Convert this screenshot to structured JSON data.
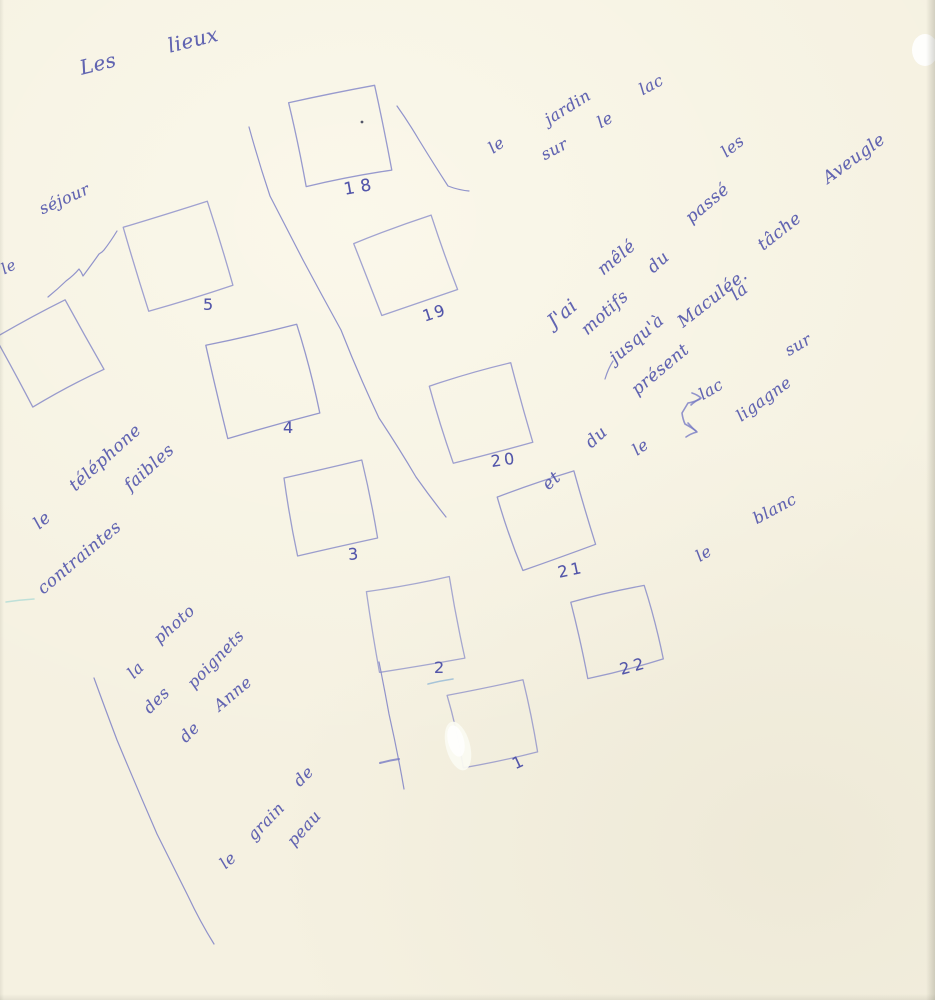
{
  "document": {
    "kind": "scanned handwritten notebook page",
    "language": "French",
    "paper_color": "#f5f1e1",
    "ink_color": "#5558ad",
    "transcription": {
      "title": "Les lieux",
      "notes": [
        "le séjour",
        "le téléphone — contraintes faibles",
        "la photo des poignets de Anne",
        "le grain de peau",
        "le jardin sur le lac",
        "J'ai mêlé les motifs du passé et du présent jusqu'à la tâche Aveugle Maculée.",
        "le lac — ligagne — sur",
        "le blanc"
      ],
      "numbered_squares": [
        "1",
        "2",
        "3",
        "4",
        "5",
        "18",
        "19",
        "20",
        "21",
        "22"
      ],
      "unnumbered_squares": 1
    }
  },
  "sketch": {
    "ink": "#777bc4",
    "words": [
      {
        "name": "title-word-les",
        "t": "Les",
        "x": 80,
        "y": 66,
        "r": -14,
        "s": 20
      },
      {
        "name": "title-word-lieux",
        "t": "lieux",
        "x": 168,
        "y": 44,
        "r": -14,
        "s": 20
      },
      {
        "name": "note-le-edge",
        "t": "le",
        "x": 2,
        "y": 268,
        "r": -26,
        "s": 15
      },
      {
        "name": "note-sejour",
        "t": "séjour",
        "x": 40,
        "y": 208,
        "r": -24,
        "s": 16
      },
      {
        "name": "tel-le",
        "t": "le",
        "x": 36,
        "y": 524,
        "r": -40,
        "s": 17
      },
      {
        "name": "tel-telephone",
        "t": "téléphone",
        "x": 72,
        "y": 486,
        "r": -42,
        "s": 17
      },
      {
        "name": "tel-contraintes",
        "t": "contraintes",
        "x": 40,
        "y": 589,
        "r": -40,
        "s": 17
      },
      {
        "name": "tel-faibles",
        "t": "faibles",
        "x": 127,
        "y": 486,
        "r": -42,
        "s": 17
      },
      {
        "name": "photo-la",
        "t": "la",
        "x": 130,
        "y": 674,
        "r": -45,
        "s": 16
      },
      {
        "name": "photo-photo",
        "t": "photo",
        "x": 156,
        "y": 639,
        "r": -42,
        "s": 16
      },
      {
        "name": "photo-des",
        "t": "des",
        "x": 146,
        "y": 709,
        "r": -45,
        "s": 16
      },
      {
        "name": "photo-poignets",
        "t": "poignets",
        "x": 190,
        "y": 684,
        "r": -46,
        "s": 16
      },
      {
        "name": "photo-de",
        "t": "de",
        "x": 182,
        "y": 738,
        "r": -45,
        "s": 16
      },
      {
        "name": "photo-anne",
        "t": "Anne",
        "x": 216,
        "y": 706,
        "r": -40,
        "s": 16
      },
      {
        "name": "grain-le",
        "t": "le",
        "x": 222,
        "y": 864,
        "r": -42,
        "s": 16
      },
      {
        "name": "grain-grain",
        "t": "grain",
        "x": 250,
        "y": 836,
        "r": -46,
        "s": 16
      },
      {
        "name": "grain-de",
        "t": "de",
        "x": 296,
        "y": 782,
        "r": -45,
        "s": 16
      },
      {
        "name": "grain-peau",
        "t": "peau",
        "x": 290,
        "y": 842,
        "r": -48,
        "s": 16
      },
      {
        "name": "jardin-le",
        "t": "le",
        "x": 490,
        "y": 148,
        "r": -35,
        "s": 16
      },
      {
        "name": "jardin-jardin",
        "t": "jardin",
        "x": 546,
        "y": 119,
        "r": -32,
        "s": 16
      },
      {
        "name": "jardin-sur",
        "t": "sur",
        "x": 542,
        "y": 154,
        "r": -28,
        "s": 16
      },
      {
        "name": "jardin-le2",
        "t": "le",
        "x": 598,
        "y": 122,
        "r": -28,
        "s": 16
      },
      {
        "name": "jardin-lac",
        "t": "lac",
        "x": 640,
        "y": 89,
        "r": -28,
        "s": 16
      },
      {
        "name": "mele-jai",
        "t": "J'ai",
        "x": 550,
        "y": 322,
        "r": -40,
        "s": 19
      },
      {
        "name": "mele-mele",
        "t": "mêlé",
        "x": 600,
        "y": 270,
        "r": -40,
        "s": 17
      },
      {
        "name": "mele-les",
        "t": "les",
        "x": 723,
        "y": 152,
        "r": -38,
        "s": 16
      },
      {
        "name": "mele-motifs",
        "t": "motifs",
        "x": 584,
        "y": 330,
        "r": -42,
        "s": 17
      },
      {
        "name": "mele-du1",
        "t": "du",
        "x": 650,
        "y": 268,
        "r": -42,
        "s": 17
      },
      {
        "name": "mele-passe",
        "t": "passé",
        "x": 688,
        "y": 218,
        "r": -40,
        "s": 17
      },
      {
        "name": "mele-et",
        "t": "et",
        "x": 545,
        "y": 485,
        "r": -42,
        "s": 17
      },
      {
        "name": "mele-du2",
        "t": "du",
        "x": 588,
        "y": 443,
        "r": -42,
        "s": 17
      },
      {
        "name": "mele-present",
        "t": "présent",
        "x": 634,
        "y": 390,
        "r": -40,
        "s": 17
      },
      {
        "name": "mele-jusqua",
        "t": "jusqu'à",
        "x": 612,
        "y": 358,
        "r": -40,
        "s": 17
      },
      {
        "name": "mele-la",
        "t": "la",
        "x": 733,
        "y": 295,
        "r": -38,
        "s": 17
      },
      {
        "name": "mele-tache",
        "t": "tâche",
        "x": 760,
        "y": 245,
        "r": -38,
        "s": 17
      },
      {
        "name": "mele-aveugle",
        "t": "Aveugle",
        "x": 825,
        "y": 178,
        "r": -36,
        "s": 17
      },
      {
        "name": "mele-maculee",
        "t": "Maculée.",
        "x": 680,
        "y": 322,
        "r": -38,
        "s": 17
      },
      {
        "name": "lac-le",
        "t": "le",
        "x": 634,
        "y": 450,
        "r": -35,
        "s": 16
      },
      {
        "name": "lac-lac",
        "t": "lac",
        "x": 700,
        "y": 394,
        "r": -30,
        "s": 16
      },
      {
        "name": "lac-ligagne",
        "t": "ligagne",
        "x": 738,
        "y": 416,
        "r": -36,
        "s": 16
      },
      {
        "name": "lac-sur",
        "t": "sur",
        "x": 786,
        "y": 350,
        "r": -30,
        "s": 16
      },
      {
        "name": "blanc-le",
        "t": "le",
        "x": 697,
        "y": 556,
        "r": -32,
        "s": 16
      },
      {
        "name": "blanc-blanc",
        "t": "blanc",
        "x": 754,
        "y": 518,
        "r": -28,
        "s": 16
      },
      {
        "name": "num-5",
        "t": "5",
        "x": 203,
        "y": 303,
        "r": 0,
        "s": 16,
        "num": true
      },
      {
        "name": "num-4",
        "t": "4",
        "x": 283,
        "y": 426,
        "r": 0,
        "s": 16,
        "num": true
      },
      {
        "name": "num-3",
        "t": "3",
        "x": 348,
        "y": 553,
        "r": -5,
        "s": 16,
        "num": true
      },
      {
        "name": "num-2",
        "t": "2",
        "x": 434,
        "y": 666,
        "r": 0,
        "s": 16,
        "num": true
      },
      {
        "name": "num-1",
        "t": "1",
        "x": 513,
        "y": 763,
        "r": -25,
        "s": 16,
        "num": true
      },
      {
        "name": "num-18",
        "t": "18",
        "x": 344,
        "y": 188,
        "r": -10,
        "s": 17,
        "num": true,
        "ls": 6
      },
      {
        "name": "num-19",
        "t": "19",
        "x": 423,
        "y": 315,
        "r": -18,
        "s": 16,
        "num": true,
        "ls": 2
      },
      {
        "name": "num-20",
        "t": "20",
        "x": 491,
        "y": 460,
        "r": -8,
        "s": 16,
        "num": true,
        "ls": 3
      },
      {
        "name": "num-21",
        "t": "21",
        "x": 558,
        "y": 571,
        "r": -12,
        "s": 16,
        "num": true,
        "ls": 3
      },
      {
        "name": "num-22",
        "t": "22",
        "x": 620,
        "y": 668,
        "r": -15,
        "s": 16,
        "num": true,
        "ls": 4
      }
    ],
    "squares": [
      {
        "name": "square-unnumbered",
        "label": "",
        "cx": 50,
        "cy": 353,
        "side": 80,
        "rot": -28
      },
      {
        "name": "square-5",
        "label": "5",
        "cx": 177,
        "cy": 256,
        "side": 88,
        "rot": -17
      },
      {
        "name": "square-4",
        "label": "4",
        "cx": 262,
        "cy": 380,
        "side": 94,
        "rot": -14
      },
      {
        "name": "square-3",
        "label": "3",
        "cx": 330,
        "cy": 507,
        "side": 80,
        "rot": -12
      },
      {
        "name": "square-2",
        "label": "2",
        "cx": 415,
        "cy": 624,
        "side": 84,
        "rot": -10
      },
      {
        "name": "square-1",
        "label": "1",
        "cx": 492,
        "cy": 724,
        "side": 76,
        "rot": -12
      },
      {
        "name": "square-18",
        "label": "18",
        "cx": 340,
        "cy": 137,
        "side": 86,
        "rot": -12
      },
      {
        "name": "square-19",
        "label": "19",
        "cx": 406,
        "cy": 266,
        "side": 80,
        "rot": -20
      },
      {
        "name": "square-20",
        "label": "20",
        "cx": 481,
        "cy": 414,
        "side": 82,
        "rot": -16
      },
      {
        "name": "square-21",
        "label": "21",
        "cx": 548,
        "cy": 521,
        "side": 78,
        "rot": -18
      },
      {
        "name": "square-22",
        "label": "22",
        "cx": 616,
        "cy": 631,
        "side": 76,
        "rot": -14
      }
    ],
    "lines": [
      {
        "name": "center-diagonal-line",
        "pts": [
          [
            249,
            127
          ],
          [
            270,
            196
          ],
          [
            303,
            260
          ],
          [
            341,
            330
          ],
          [
            379,
            418
          ],
          [
            416,
            477
          ],
          [
            446,
            517
          ]
        ]
      },
      {
        "name": "line-beside-square-18",
        "pts": [
          [
            397,
            106
          ],
          [
            419,
            140
          ],
          [
            448,
            186
          ],
          [
            469,
            191
          ]
        ]
      },
      {
        "name": "left-long-line",
        "pts": [
          [
            94,
            678
          ],
          [
            117,
            740
          ],
          [
            157,
            834
          ],
          [
            188,
            896
          ],
          [
            214,
            944
          ]
        ]
      },
      {
        "name": "line-beside-square-1",
        "pts": [
          [
            379,
            662
          ],
          [
            389,
            714
          ],
          [
            404,
            789
          ]
        ]
      },
      {
        "name": "tick-on-line",
        "pts": [
          [
            380,
            763
          ],
          [
            399,
            759
          ]
        ],
        "w": 2
      },
      {
        "name": "zigzag-mark",
        "pts": [
          [
            48,
            297
          ],
          [
            66,
            281
          ],
          [
            79,
            269
          ],
          [
            83,
            276
          ],
          [
            99,
            254
          ],
          [
            104,
            250
          ],
          [
            117,
            231
          ]
        ]
      },
      {
        "name": "underline-2",
        "pts": [
          [
            428,
            684
          ],
          [
            453,
            679
          ]
        ],
        "color": "#93b9d6",
        "w": 1.6,
        "o": 0.8
      },
      {
        "name": "cyan-scan-mark",
        "pts": [
          [
            6,
            602
          ],
          [
            34,
            599
          ]
        ],
        "color": "#8fd2cf",
        "w": 1.5,
        "o": 0.55
      },
      {
        "name": "small-slash",
        "pts": [
          [
            613,
            361
          ],
          [
            605,
            379
          ]
        ]
      },
      {
        "name": "arrow-curve",
        "pts": [
          [
            700,
            399
          ],
          [
            688,
            403
          ],
          [
            682,
            413
          ],
          [
            685,
            424
          ],
          [
            696,
            431
          ]
        ],
        "w": 1.6
      },
      {
        "name": "arrow-head-top",
        "pts": [
          [
            691,
            405
          ],
          [
            701,
            398
          ],
          [
            692,
            393
          ]
        ],
        "w": 1.6
      },
      {
        "name": "arrow-head-bottom",
        "pts": [
          [
            688,
            423
          ],
          [
            697,
            432
          ],
          [
            686,
            437
          ]
        ],
        "w": 1.6
      }
    ],
    "marks": [
      {
        "name": "ink-dot-in-square-18",
        "type": "dot",
        "cx": 362,
        "cy": 122,
        "r": 1.4,
        "fill": "#40445a",
        "opacity": 0.9
      },
      {
        "name": "whiteout-patch",
        "type": "ellipse",
        "cx": 458,
        "cy": 746,
        "rx": 12,
        "ry": 25,
        "rot": -15,
        "fill": "#fafaf1",
        "opacity": 0.95
      },
      {
        "name": "whiteout-core",
        "type": "ellipse",
        "cx": 456,
        "cy": 741,
        "rx": 8,
        "ry": 16,
        "rot": -15,
        "fill": "#ffffff",
        "opacity": 0.8
      },
      {
        "name": "corner-notch",
        "type": "ellipse",
        "cx": 925,
        "cy": 50,
        "rx": 13,
        "ry": 16,
        "rot": 0,
        "fill": "#ffffff",
        "opacity": 0.9
      }
    ]
  }
}
